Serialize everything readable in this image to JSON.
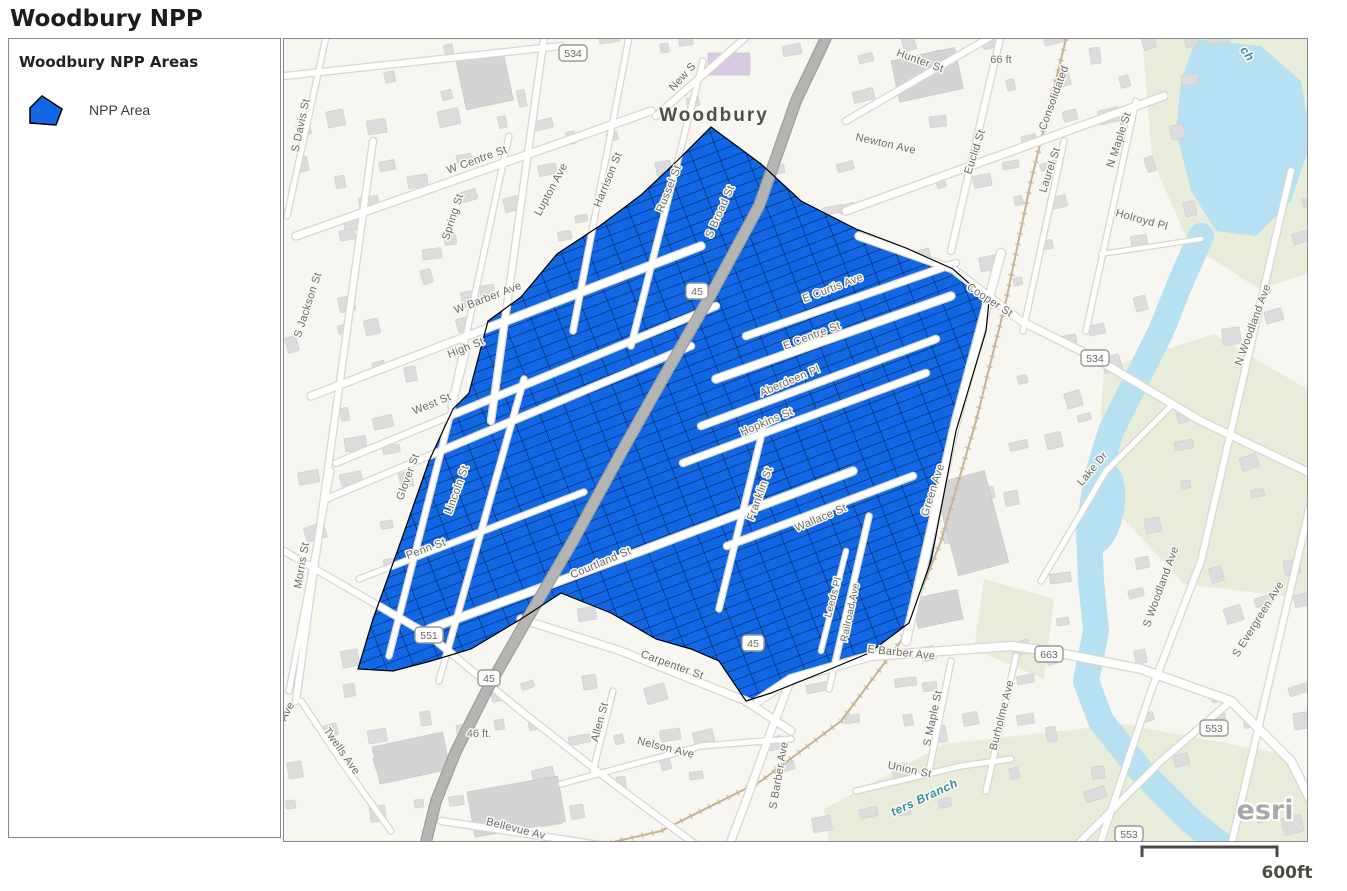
{
  "page": {
    "title": "Woodbury NPP"
  },
  "legend": {
    "title": "Woodbury NPP Areas",
    "items": [
      {
        "label": "NPP Area",
        "color": "#1167e4"
      }
    ]
  },
  "map": {
    "attribution": "esri",
    "scale_bar": {
      "label": "600ft"
    },
    "colors": {
      "npp_fill": "#1167e4",
      "npp_outline": "#000000",
      "water": "#b6e1f2",
      "water_label": "#3d8fa0",
      "bg": "#f7f6f0",
      "green": "#e4ebd4",
      "building": "#dcdcdc",
      "building_edge": "#c9c9c9",
      "road_white": "#ffffff",
      "road_casing": "#d8d7d2",
      "road_major": "#b4b4b3",
      "road_major_edge": "#9e9e9e",
      "rail": "#c7b292",
      "street_label": "#6b6b6b",
      "city_label": "#4f4f4f",
      "shield_text": "#6b6b6b",
      "shield_border": "#9a9a97",
      "elevation_label": "#767676",
      "attribution_color": "#a9a9a9",
      "scale_color": "#4c4a44"
    },
    "city_labels": [
      {
        "text": "Woodbury",
        "x": 430,
        "y": 82,
        "rot": 0,
        "size": 19
      }
    ],
    "street_labels": [
      {
        "text": "S Davis St",
        "x": 20,
        "y": 87,
        "rot": -78
      },
      {
        "text": "S Jackson St",
        "x": 27,
        "y": 267,
        "rot": -72
      },
      {
        "text": "Morris St",
        "x": 21,
        "y": 527,
        "rot": -80
      },
      {
        "text": "Spring St",
        "x": 172,
        "y": 179,
        "rot": -72
      },
      {
        "text": "W Centre St",
        "x": 194,
        "y": 124,
        "rot": -20
      },
      {
        "text": "Lupton Ave",
        "x": 270,
        "y": 152,
        "rot": -62
      },
      {
        "text": "Harrison St",
        "x": 327,
        "y": 142,
        "rot": -68
      },
      {
        "text": "Russel St",
        "x": 388,
        "y": 151,
        "rot": -68
      },
      {
        "text": "New S",
        "x": 401,
        "y": 40,
        "rot": -48
      },
      {
        "text": "W Barber Ave",
        "x": 205,
        "y": 262,
        "rot": -21
      },
      {
        "text": "High St",
        "x": 183,
        "y": 312,
        "rot": -22
      },
      {
        "text": "West St",
        "x": 149,
        "y": 368,
        "rot": -22
      },
      {
        "text": "Glover St",
        "x": 127,
        "y": 439,
        "rot": -70
      },
      {
        "text": "Lincoln St",
        "x": 176,
        "y": 452,
        "rot": -70
      },
      {
        "text": "Penn St",
        "x": 143,
        "y": 513,
        "rot": -20
      },
      {
        "text": "Courtland St",
        "x": 318,
        "y": 527,
        "rot": -23
      },
      {
        "text": "Carpenter St",
        "x": 387,
        "y": 629,
        "rot": 20
      },
      {
        "text": "Allen St",
        "x": 319,
        "y": 684,
        "rot": -75
      },
      {
        "text": "Nelson Ave",
        "x": 381,
        "y": 712,
        "rot": 14
      },
      {
        "text": "S Barber Ave",
        "x": 498,
        "y": 737,
        "rot": -80
      },
      {
        "text": "Union St",
        "x": 625,
        "y": 734,
        "rot": 12
      },
      {
        "text": "S Maple St",
        "x": 652,
        "y": 680,
        "rot": -78
      },
      {
        "text": "Burholme Ave",
        "x": 721,
        "y": 677,
        "rot": -76
      },
      {
        "text": "Bellevue Av",
        "x": 231,
        "y": 793,
        "rot": 14
      },
      {
        "text": "Twells Ave",
        "x": 55,
        "y": 714,
        "rot": 55
      },
      {
        "text": "Ave",
        "x": 6,
        "y": 674,
        "rot": -62
      },
      {
        "text": "E Barber Ave",
        "x": 617,
        "y": 617,
        "rot": 6
      },
      {
        "text": "E Curtis Ave",
        "x": 550,
        "y": 252,
        "rot": -21
      },
      {
        "text": "E Centre St",
        "x": 529,
        "y": 300,
        "rot": -21
      },
      {
        "text": "Aberdeen Pl",
        "x": 507,
        "y": 345,
        "rot": -23
      },
      {
        "text": "Hopkins St",
        "x": 484,
        "y": 386,
        "rot": -23
      },
      {
        "text": "Franklin St",
        "x": 479,
        "y": 456,
        "rot": -70
      },
      {
        "text": "Wallace St",
        "x": 538,
        "y": 482,
        "rot": -23
      },
      {
        "text": "Leeds Pl",
        "x": 552,
        "y": 559,
        "rot": -75,
        "size": 10
      },
      {
        "text": "Railroad Ave",
        "x": 569,
        "y": 574,
        "rot": -78,
        "size": 10
      },
      {
        "text": "Green Ave",
        "x": 652,
        "y": 452,
        "rot": -72
      },
      {
        "text": "Cooper St",
        "x": 704,
        "y": 264,
        "rot": 33
      },
      {
        "text": "Euclid St",
        "x": 694,
        "y": 114,
        "rot": -72
      },
      {
        "text": "Newton Ave",
        "x": 601,
        "y": 108,
        "rot": 13
      },
      {
        "text": "Hunter St",
        "x": 635,
        "y": 25,
        "rot": 20
      },
      {
        "text": "Consolidated",
        "x": 773,
        "y": 60,
        "rot": -70
      },
      {
        "text": "Laurel St",
        "x": 769,
        "y": 132,
        "rot": -72
      },
      {
        "text": "N Maple St",
        "x": 838,
        "y": 102,
        "rot": -72
      },
      {
        "text": "Holroyd Pl",
        "x": 857,
        "y": 184,
        "rot": 15
      },
      {
        "text": "S Broad St",
        "x": 439,
        "y": 174,
        "rot": -66
      },
      {
        "text": "Lake Dr",
        "x": 811,
        "y": 432,
        "rot": -50
      },
      {
        "text": "N Woodland Ave",
        "x": 972,
        "y": 287,
        "rot": -70
      },
      {
        "text": "S Woodland Ave",
        "x": 880,
        "y": 549,
        "rot": -70
      },
      {
        "text": "S Evergreen Ave",
        "x": 977,
        "y": 582,
        "rot": -58
      }
    ],
    "route_shields": [
      {
        "text": "534",
        "x": 289,
        "y": 14
      },
      {
        "text": "45",
        "x": 413,
        "y": 252
      },
      {
        "text": "45",
        "x": 205,
        "y": 639
      },
      {
        "text": "45",
        "x": 469,
        "y": 604
      },
      {
        "text": "551",
        "x": 145,
        "y": 596
      },
      {
        "text": "663",
        "x": 765,
        "y": 615
      },
      {
        "text": "534",
        "x": 811,
        "y": 319
      },
      {
        "text": "553",
        "x": 930,
        "y": 689
      },
      {
        "text": "553",
        "x": 845,
        "y": 795
      }
    ],
    "elevation_labels": [
      {
        "text": "66 ft",
        "x": 717,
        "y": 24
      },
      {
        "text": "46 ft.",
        "x": 195,
        "y": 698
      }
    ],
    "water_labels": [
      {
        "text": "ters Branch",
        "x": 642,
        "y": 762,
        "rot": -25
      },
      {
        "text": "ch",
        "x": 960,
        "y": 17,
        "rot": 55
      }
    ]
  }
}
